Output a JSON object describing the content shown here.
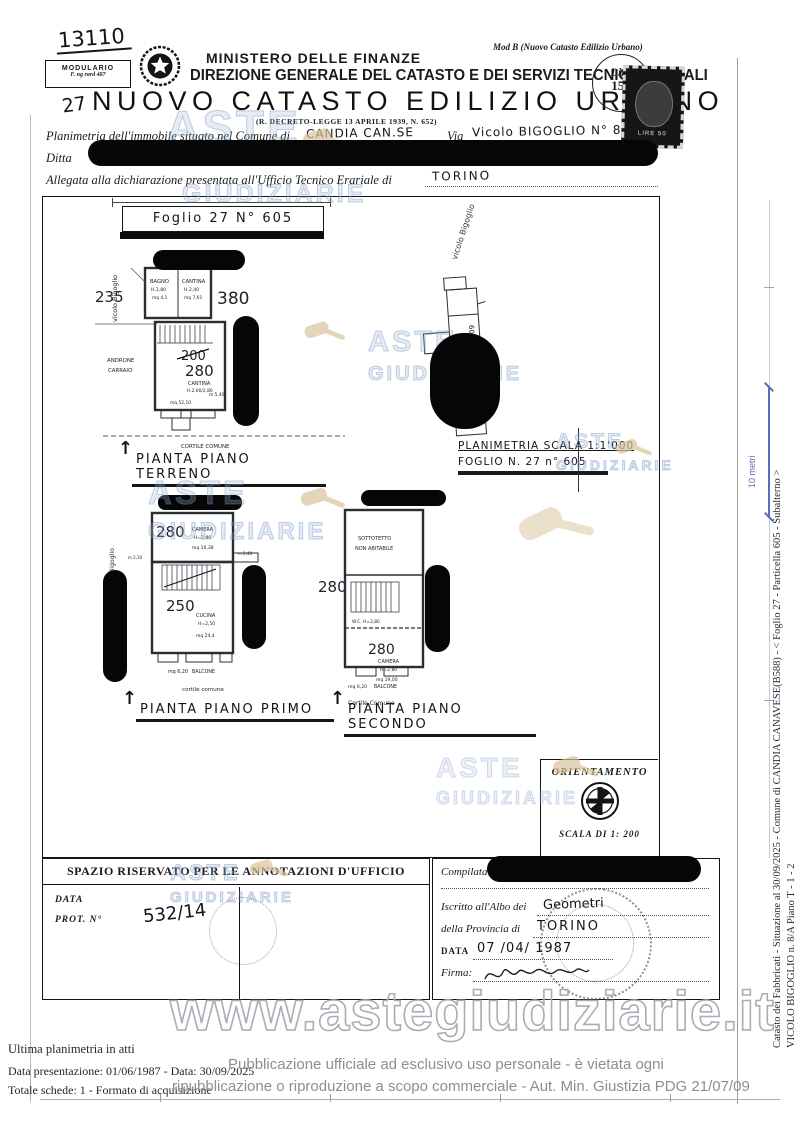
{
  "header": {
    "sheet_number": "13110",
    "modulario_line1": "MODULARIO",
    "modulario_line2": "F. ng rard 487",
    "mod_b": "Mod B (Nuovo Catasto Edilizio Urbano)",
    "ministero": "MINISTERO DELLE FINANZE",
    "direzione": "DIREZIONE GENERALE DEL CATASTO E DEI SERVIZI TECNICI ERARIALI",
    "page_num": "27",
    "title": "NUOVO CATASTO EDILIZIO URBANO",
    "decreto": "(R. DECRETO-LEGGE 13 APRILE 1939, N. 652)",
    "lire_label": "Lire",
    "lire_value": "150",
    "stamp_text": "LIRE 50"
  },
  "form": {
    "comune_label": "Planimetria dell'immobile situato nel Comune di",
    "comune_value": "CANDIA CAN.SE",
    "via_label": "Via",
    "via_value": "Vicolo BIGOGLIO N° 8/A",
    "ditta_label": "Ditta",
    "allegata_label": "Allegata alla dichiarazione presentata all'Ufficio Tecnico Erariale di",
    "allegata_value": "TORINO"
  },
  "drawing": {
    "foglio_header": "Foglio 27 N° 605",
    "ground": {
      "dim_left": "235",
      "street": "vicolo Bigoglio",
      "dim_right": "380",
      "room1_name": "BAGNO",
      "room1_h": "H.2,80",
      "room1_mq": "mq 4,1",
      "room2_name": "CANTINA",
      "room2_h": "H.2,40",
      "room2_mq": "mq 7,61",
      "value_old": "200",
      "value_new": "280",
      "room3_name": "CANTINA",
      "room3_h": "H.2,00/2,80",
      "room3_dim": "m 5,40",
      "room3_mq": "mq 52,10",
      "androne_line1": "ANDRONE",
      "androne_line2": "CARRAIO",
      "cortile": "CORTILE COMUNE",
      "label": "PIANTA PIANO TERRENO"
    },
    "map": {
      "street": "vicolo Bigoglio",
      "parcel1": "605",
      "parcel2": "604",
      "parcel3": "603"
    },
    "plan_ref_line1": "PLANIMETRIA SCALA 1:1'000",
    "plan_ref_line2": "FOGLIO N. 27 n° 605",
    "first": {
      "street": "vicolo Bigoglio",
      "value1": "280",
      "room1_name": "CAMERA",
      "room1_h": "H=2,80",
      "room1_mq": "mq 16,38",
      "dim_left": "m 2,10",
      "dim_right": "m 2,40",
      "value2": "250",
      "room2_name": "CUCINA",
      "room2_h": "H=2,50",
      "room2_mq": "mq 24,4",
      "balcone_mq": "mq 6,20",
      "balcone": "BALCONE",
      "cortile": "cortile comune",
      "label": "PIANTA PIANO PRIMO"
    },
    "second": {
      "dim_left": "280",
      "attic_line1": "SOTTOTETTO",
      "attic_line2": "NON ABITABILE",
      "wc": "W.C. H=2,80",
      "value": "280",
      "room_name": "CAMERA",
      "room_h": "H=2,80",
      "room_mq": "mq 19,00",
      "balcone_mq": "mq 6,20",
      "balcone": "BALCONE",
      "cortile": "Cortile Comune",
      "label": "PIANTA PIANO SECONDO"
    },
    "orientamento": "ORIENTAMENTO",
    "scala": "SCALA DI 1: 200"
  },
  "annotations": {
    "title": "SPAZIO RISERVATO PER LE ANNOTAZIONI D'UFFICIO",
    "data_label": "DATA",
    "prot_label": "PROT. N°",
    "prot_value": "532/14"
  },
  "compiled": {
    "compilata_label": "Compilata d",
    "iscritto_label": "Iscritto all'Albo dei",
    "iscritto_value": "Geometri",
    "provincia_label": "della Provincia di",
    "provincia_value": "TORINO",
    "data_label": "DATA",
    "data_value": "07 /04/ 1987",
    "firma_label": "Firma:"
  },
  "sidebar": {
    "line1": "Catasto dei Fabbricati - Situazione al 30/09/2025 - Comune di CANDIA CANAVESE(B588) - <  Foglio 27 - Particella  605 - Subalterno  >",
    "line2": "VICOLO BIGOGLIO n. 8/A Piano T - 1 - 2",
    "scale_label": "10 metri"
  },
  "watermark": {
    "word1": "ASTE",
    "word2": "GIUDIZIARIE",
    "url": "www.astegiudiziarie.it",
    "color": "#7d9bc4",
    "gavel_color": "#d9c49c"
  },
  "footer": {
    "line1": "Ultima planimetria in atti",
    "line2": "Data presentazione: 01/06/1987 - Data: 30/09/2025",
    "line3": "Totale schede: 1 - Formato di acquisizione",
    "overlay1": "Pubblicazione ufficiale ad esclusivo uso personale - è vietata ogni",
    "overlay2": "ripubblicazione o riproduzione a scopo commerciale - Aut. Min. Giustizia PDG 21/07/09"
  }
}
